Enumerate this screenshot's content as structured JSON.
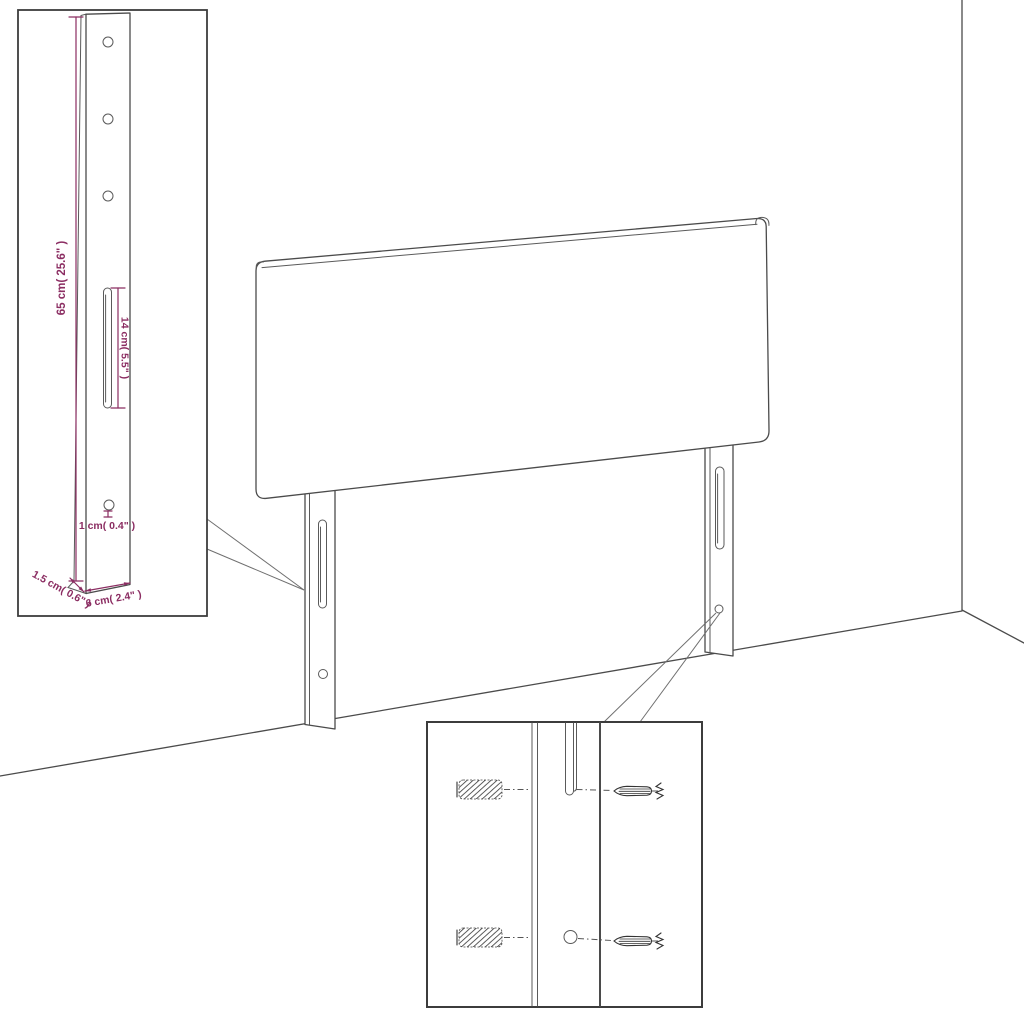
{
  "title": "Headboard wall-mount assembly diagram",
  "colors": {
    "dimension_text": "#8B2D62",
    "outline_gray": "#4B4B4B",
    "inset_border": "#3C3C3C",
    "background": "#FFFFFF"
  },
  "leg_detail": {
    "height_label": "65 cm( 25.6\" )",
    "slot_label": "14 cm( 5.5\" )",
    "hole_label": "1 cm( 0.4\" )",
    "thickness_label": "1.5 cm( 0.6\" )",
    "width_label": "6 cm( 2.4\" )"
  },
  "parts": {
    "panel": "upholstered headboard panel",
    "legs": "slotted wall-mount legs",
    "hardware": "wall plugs and screws"
  }
}
